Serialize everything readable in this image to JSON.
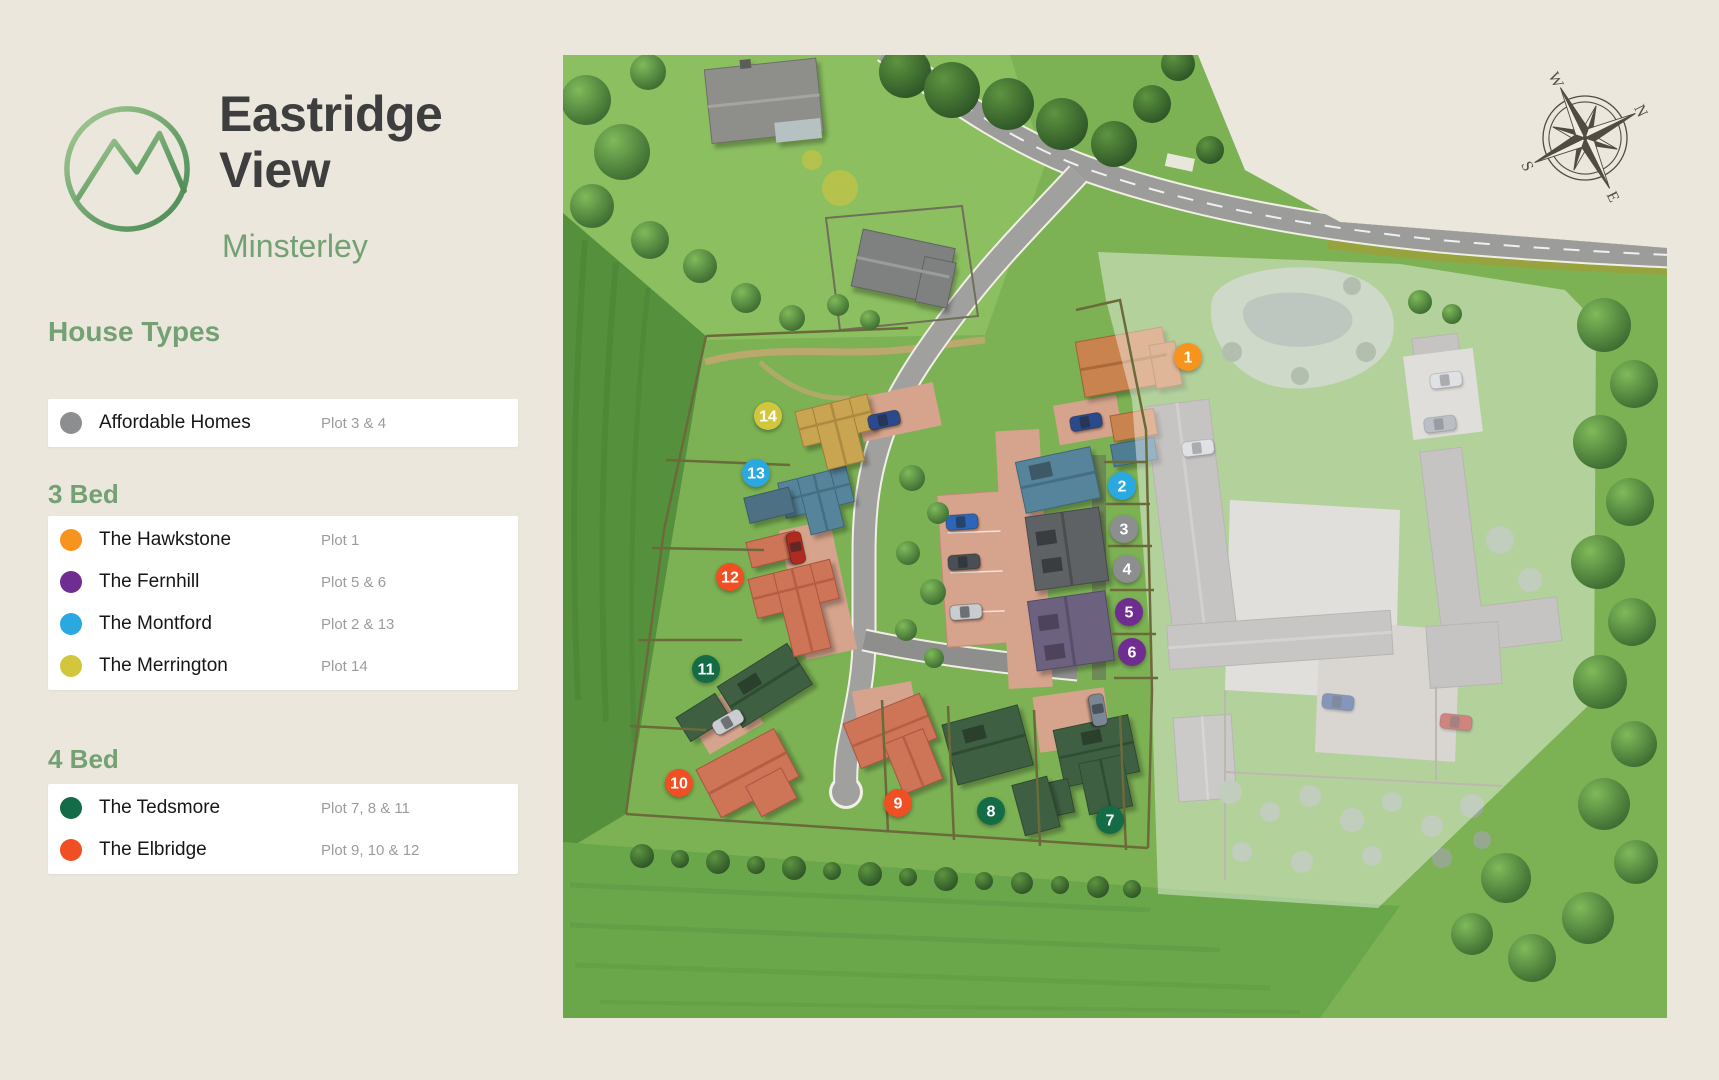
{
  "brand": {
    "title_line1": "Eastridge",
    "title_line2": "View",
    "location": "Minsterley"
  },
  "legend": {
    "title": "House Types",
    "sections": [
      {
        "heading": "",
        "items": [
          {
            "name": "Affordable Homes",
            "plots": "Plot 3 & 4",
            "color": "#8C8E90"
          }
        ]
      },
      {
        "heading": "3 Bed",
        "items": [
          {
            "name": "The Hawkstone",
            "plots": "Plot 1",
            "color": "#F7941E"
          },
          {
            "name": "The Fernhill",
            "plots": "Plot 5 & 6",
            "color": "#6F2D91"
          },
          {
            "name": "The Montford",
            "plots": "Plot 2 & 13",
            "color": "#29A9E0"
          },
          {
            "name": "The Merrington",
            "plots": "Plot 14",
            "color": "#D2C63C"
          }
        ]
      },
      {
        "heading": "4 Bed",
        "items": [
          {
            "name": "The Tedsmore",
            "plots": "Plot 7, 8 & 11",
            "color": "#136C45"
          },
          {
            "name": "The Elbridge",
            "plots": "Plot 9, 10 & 12",
            "color": "#F04E23"
          }
        ]
      }
    ]
  },
  "compass": {
    "n": "N",
    "e": "E",
    "s": "S",
    "w": "W"
  },
  "map": {
    "markers": [
      {
        "label": "1",
        "color": "#F7941E"
      },
      {
        "label": "2",
        "color": "#29A9E0"
      },
      {
        "label": "3",
        "color": "#8C8E90"
      },
      {
        "label": "4",
        "color": "#8C8E90"
      },
      {
        "label": "5",
        "color": "#6F2D91"
      },
      {
        "label": "6",
        "color": "#6F2D91"
      },
      {
        "label": "7",
        "color": "#136C45"
      },
      {
        "label": "8",
        "color": "#136C45"
      },
      {
        "label": "9",
        "color": "#F04E23"
      },
      {
        "label": "10",
        "color": "#F04E23"
      },
      {
        "label": "11",
        "color": "#136C45"
      },
      {
        "label": "12",
        "color": "#F04E23"
      },
      {
        "label": "13",
        "color": "#29A9E0"
      },
      {
        "label": "14",
        "color": "#D2C63C"
      }
    ]
  }
}
